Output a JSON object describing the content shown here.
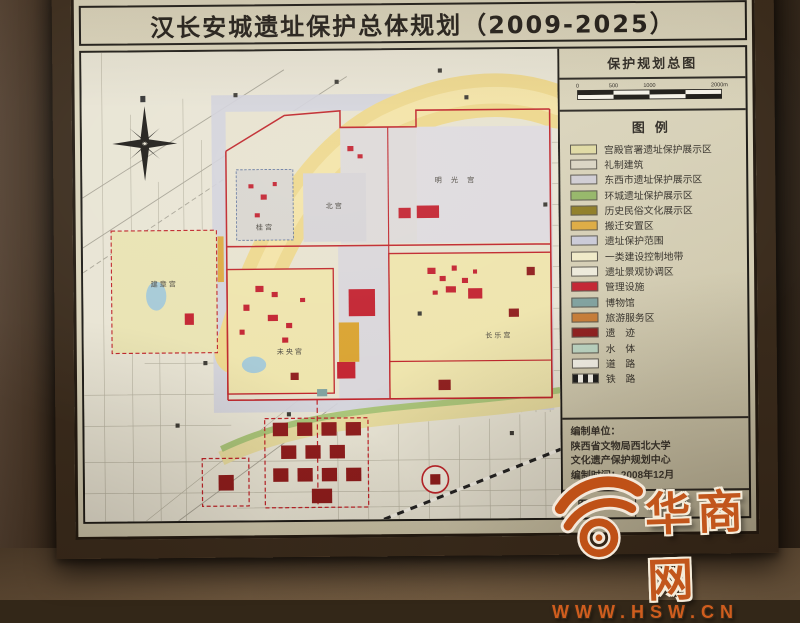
{
  "title": "汉长安城遗址保护总体规划（2009-2025）",
  "map_panel": {
    "title": "保护规划总图",
    "scale_labels": [
      "0",
      "500",
      "1000",
      "2000m"
    ]
  },
  "legend": {
    "title": "图例",
    "items": [
      {
        "label": "宫殿官署遗址保护展示区",
        "color": "#dfd9a2",
        "type": "fill"
      },
      {
        "label": "礼制建筑",
        "color": "#d9d4c2",
        "type": "fill"
      },
      {
        "label": "东西市遗址保护展示区",
        "color": "#cfccd2",
        "type": "fill"
      },
      {
        "label": "环城遗址保护展示区",
        "color": "#93b565",
        "type": "fill"
      },
      {
        "label": "历史民俗文化展示区",
        "color": "#8d7b22",
        "type": "fill"
      },
      {
        "label": "搬迁安置区",
        "color": "#dca93e",
        "type": "fill"
      },
      {
        "label": "遗址保护范围",
        "color": "#c9c9d6",
        "type": "fill"
      },
      {
        "label": "一类建设控制地带",
        "color": "#efe9c6",
        "type": "fill"
      },
      {
        "label": "遗址景观协调区",
        "color": "#ece9da",
        "type": "fill"
      },
      {
        "label": "管理设施",
        "color": "#c2202e",
        "type": "fill"
      },
      {
        "label": "博物馆",
        "color": "#7fa19e",
        "type": "fill"
      },
      {
        "label": "旅游服务区",
        "color": "#c87c35",
        "type": "fill"
      },
      {
        "label": "遗　迹",
        "color": "#8f1c1c",
        "type": "fill"
      },
      {
        "label": "水　体",
        "color": "#bdd7c4",
        "type": "fill"
      },
      {
        "label": "道　路",
        "color": "#f5f2e8",
        "type": "fill"
      },
      {
        "label": "铁　路",
        "color": "",
        "type": "railroad"
      }
    ]
  },
  "credits": {
    "heading": "编制单位：",
    "org1": "陕西省文物局西北大学",
    "org2": "文化遗产保护规划中心",
    "date_line": "编制时间：2008年12月"
  },
  "drawing_box": {
    "label": "图 号"
  },
  "map": {
    "labels": [
      {
        "text": "建章宫"
      },
      {
        "text": "未央宫"
      },
      {
        "text": "长乐宫"
      },
      {
        "text": "桂宫"
      },
      {
        "text": "北宫"
      },
      {
        "text": "明光宫"
      }
    ],
    "colors": {
      "boundary_red": "#bf2329",
      "ruin_dark_red": "#8f1c1c",
      "facility_red": "#c2202e",
      "palace_yellow": "#eee4ac",
      "river_yellow": "#edd78c",
      "protection_gray": "#d2d1db",
      "tourism_orange": "#d9a22e",
      "water_blue": "#a5c9d6",
      "green_belt": "#a9c478"
    }
  },
  "watermark": {
    "name": "华商网",
    "url": "WWW.HSW.CN"
  }
}
